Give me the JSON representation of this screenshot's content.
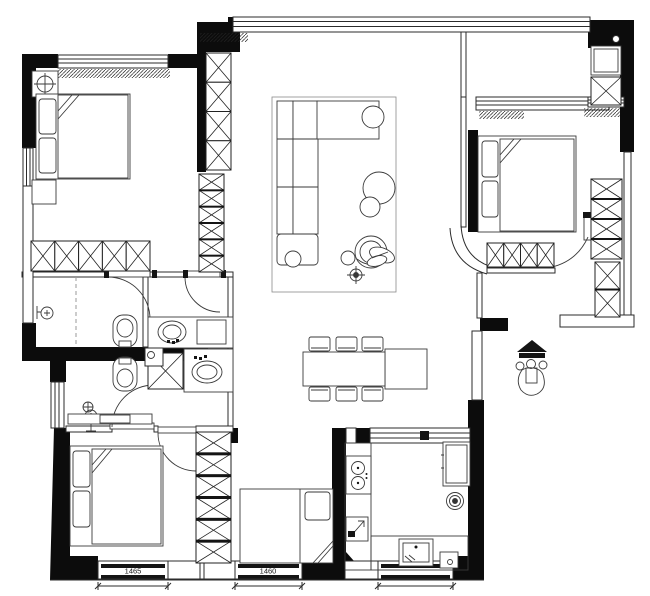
{
  "colors": {
    "background": "#ffffff",
    "walls": "#0c0c0c",
    "lines": "#2b2b2b"
  },
  "dimensions": {
    "window_left_label": "1465",
    "window_right_label": "1460"
  },
  "icons": {
    "entry_figure": "person-entry-marker-icon",
    "ceiling_symbol": "ceiling-fixture-icon",
    "lamp_symbol": "table-lamp-icon",
    "shower_symbol": "shower-head-icon",
    "floor_drain": "floor-drain-icon",
    "stove": "two-burner-stove-icon",
    "sinks": "basin-icon",
    "toilets": "toilet-icon",
    "washer": "washing-machine-icon"
  }
}
